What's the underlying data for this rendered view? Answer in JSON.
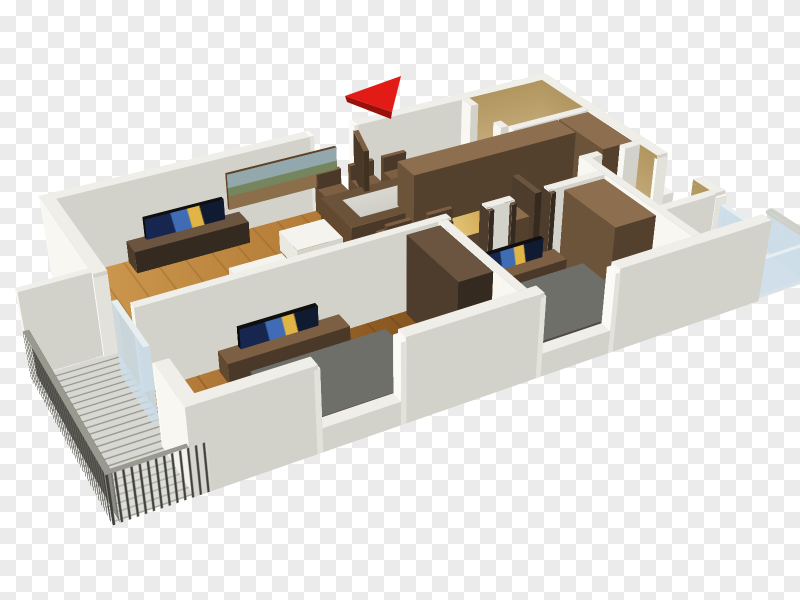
{
  "image": {
    "type": "3d-floor-plan-render",
    "description": "Isometric 3D rendering of a two-bedroom apartment floor plan with wooden floors, white walls, brown wardrobes and kitchen cabinets, two gray beds, three TVs, dining table, two bathrooms and two balconies, shown over a transparent checkerboard background with a red direction arrow at the top.",
    "aria_label": "3D floor plan of a two-bedroom apartment"
  },
  "background": {
    "checker_light": "#ffffff",
    "checker_dark": "#ebebeb",
    "tile_px": 16
  },
  "north_arrow": {
    "color": "#e31b17",
    "shade": "#9a100b",
    "direction": "left"
  },
  "scene": {
    "rooms": [
      "living-room",
      "dining-area",
      "kitchen",
      "hallway",
      "bedroom-1",
      "bedroom-2",
      "bathroom-entry",
      "bathroom-master",
      "balcony-west",
      "balcony-east"
    ],
    "furniture": [
      "tv-cabinet",
      "television",
      "wall-picture",
      "armchair",
      "ottoman",
      "side-stool",
      "dining-table",
      "dining-chairs",
      "kitchen-cabinets",
      "kitchen-counter",
      "wardrobe",
      "bed",
      "toilet",
      "vanity",
      "washing-machine",
      "air-conditioner-ledge",
      "glass-railing",
      "metal-railing",
      "open-door"
    ]
  },
  "palette": {
    "wallTop": "#efeee8",
    "wallLight": "#f8f7f2",
    "wallShade": "#d2d1ca",
    "wallBack": "#eceae3",
    "wallDark": "#c2c1ba",
    "beige": "#cdb486",
    "beigeDark": "#b1965f",
    "woodTop": "#8d6e4e",
    "woodSide": "#53402d",
    "woodMid": "#6c543b",
    "woodDarkTop": "#6b5540",
    "woodDarkSide": "#352a1f",
    "woodDarkMid": "#4e3d2c",
    "gold1": "#eacf86",
    "gold2": "#c89b43",
    "gold3": "#8f6a24",
    "bedTop": "#6f6f6a",
    "bedSide": "#4b4b47",
    "bedMid": "#5d5d58",
    "tvBlack": "#0f0f0f",
    "screenBlue1": "#16264f",
    "screenBlue2": "#3f6cb4",
    "screenGold": "#e0b445",
    "screenDark": "#101a30",
    "white1": "#f4f3ed",
    "white2": "#d5d4cc",
    "white3": "#e9e8e1",
    "dark1": "#464642",
    "dark2": "#2b2b28",
    "glassTint": "rgba(205,222,233,0.72)",
    "glassTop": "#e6eef0",
    "railBar": "#3f3e38",
    "railGap": "rgba(235,235,230,0.18)",
    "metal": "#cfcfc9",
    "floorLight": "#cf9a50",
    "floorMid": "#a86f2d",
    "floorDark": "#8a5a22",
    "floorBr1": "#bd8440",
    "floorBr2": "#8f5c23",
    "floorBr3": "#7a4c1c",
    "bathDark1": "#5c4a33",
    "bathDark2": "#463626",
    "terra1": "#c08448",
    "terra2": "#9c6630",
    "grayFloor": "#d8d8d2",
    "whiteFloor": "#ecece7",
    "picSky": "#93a8ad",
    "picLand": "#75855e",
    "picGround": "#8a6f4a",
    "picFrame": "#5e4226"
  }
}
